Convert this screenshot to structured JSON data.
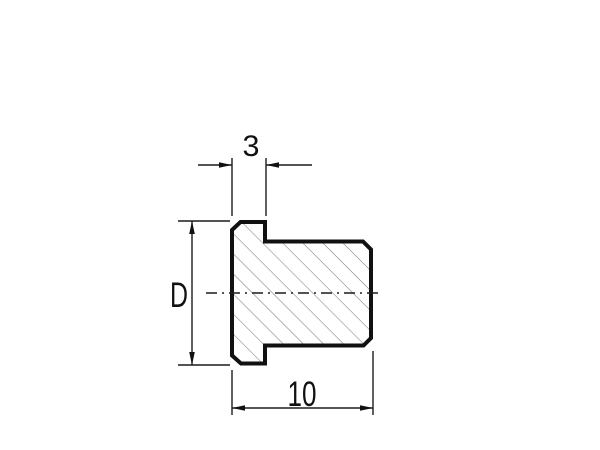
{
  "diagram": {
    "kind": "technical-section-view",
    "dimension_labels": {
      "flange_thickness": "3",
      "diameter": "D",
      "total_length": "10"
    },
    "colors": {
      "background": "#ffffff",
      "outline": "#111111",
      "hatch": "#7d7d7d",
      "dimension_lines": "#1c1c1c",
      "text": "#111111"
    }
  }
}
